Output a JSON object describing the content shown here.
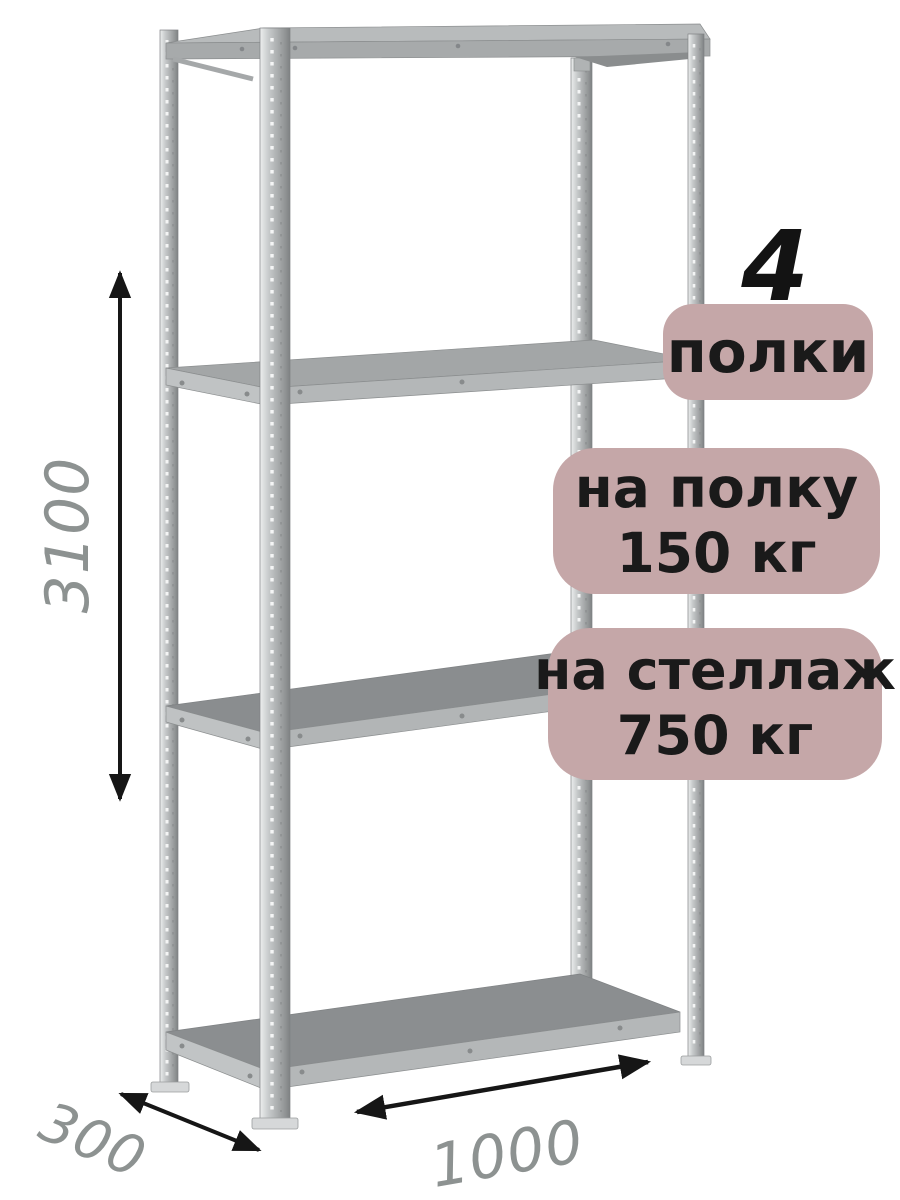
{
  "illustration": {
    "type": "metal-shelving-rack",
    "posts": 4,
    "shelves": 4,
    "metal_color": "#b8bbbc"
  },
  "dimensions": {
    "height": "3100",
    "depth": "300",
    "width": "1000",
    "text_color": "#8d9291",
    "arrow_color": "#161616"
  },
  "annotations": {
    "shelf_count": "4",
    "badge_bg": "#c5a7a8",
    "badge_text_color": "#1a1a1a",
    "badges": [
      {
        "id": "shelves",
        "lines": [
          "полки"
        ]
      },
      {
        "id": "shelf-load",
        "lines": [
          "на полку",
          "150 кг"
        ]
      },
      {
        "id": "rack-load",
        "lines": [
          "на стеллаж",
          "750 кг"
        ]
      }
    ]
  }
}
